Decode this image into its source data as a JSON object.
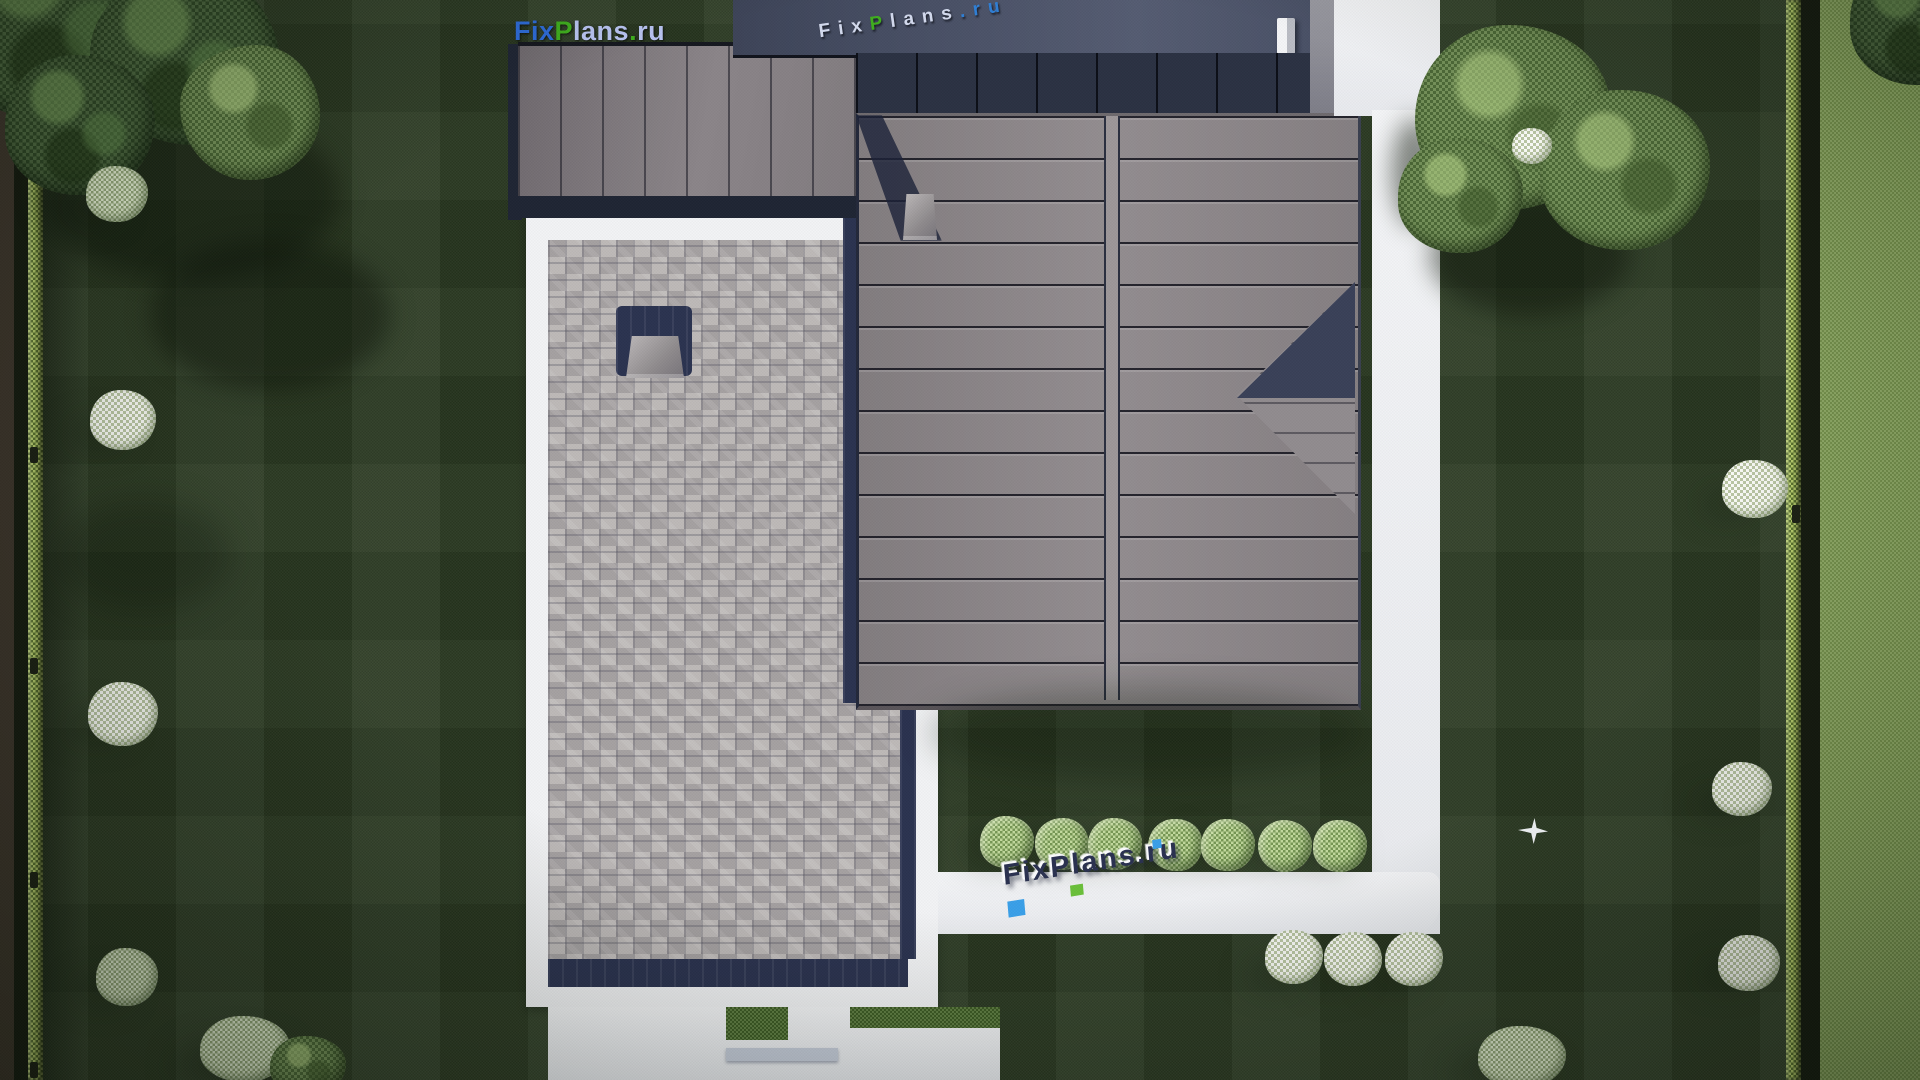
{
  "branding": {
    "logo": {
      "fix": "Fix",
      "p": "P",
      "lans": "lans",
      "dot": ".",
      "ru": "ru"
    },
    "roof_watermark": {
      "fix": "Fix",
      "p": "P",
      "lans": "lans",
      "dot": ".",
      "ru": "ru"
    },
    "path_watermark": {
      "text": "FixPlans.ru"
    }
  },
  "palette": {
    "lawn": "#2b3a22",
    "neighbor": "#87a45a",
    "hedgeGreen": "#9cb851",
    "pathWhite": "#f2f3f5",
    "paverGray": "#b2aeae",
    "navy": "#2b3350",
    "roofMain": "#8c8689",
    "roofNorth": "#434a5e",
    "logoBlue": "#2e6bd8",
    "logoGreen": "#3fae1e",
    "logoLight": "#b9c4f2",
    "wmDark": "#2a3150"
  },
  "scene": {
    "elements": [
      {
        "name": "dirt-strip-left",
        "cls": "strip-dirt",
        "x": 0,
        "y": 0,
        "w": 16,
        "h": 1080
      },
      {
        "name": "fence-strip-left",
        "cls": "strip-dark",
        "x": 14,
        "y": 0,
        "w": 16,
        "h": 1080
      },
      {
        "name": "hedge-left",
        "cls": "hedge",
        "x": 28,
        "y": 0,
        "w": 15,
        "h": 1080
      },
      {
        "name": "hedge-shadow-left",
        "cls": "shade-strip",
        "x": 43,
        "y": 0,
        "w": 46,
        "h": 1080
      },
      {
        "name": "hedge-right",
        "cls": "hedge",
        "x": 1786,
        "y": 0,
        "w": 15,
        "h": 1080
      },
      {
        "name": "fence-gap-right",
        "cls": "strip-dark",
        "x": 1801,
        "y": 0,
        "w": 21,
        "h": 1080
      },
      {
        "name": "neighbor-lawn",
        "cls": "neighbor",
        "x": 1820,
        "y": 0,
        "w": 100,
        "h": 1080
      },
      {
        "name": "fence-post-left-1",
        "cls": "post",
        "x": 30,
        "y": 447,
        "w": 8,
        "h": 16
      },
      {
        "name": "fence-post-left-2",
        "cls": "post",
        "x": 30,
        "y": 658,
        "w": 8,
        "h": 16
      },
      {
        "name": "fence-post-left-3",
        "cls": "post",
        "x": 30,
        "y": 872,
        "w": 8,
        "h": 16
      },
      {
        "name": "fence-post-left-4",
        "cls": "post",
        "x": 30,
        "y": 1062,
        "w": 8,
        "h": 16
      },
      {
        "name": "fence-post-right",
        "cls": "post",
        "x": 1792,
        "y": 505,
        "w": 8,
        "h": 18
      },
      {
        "name": "tree-shadow-topleft-1",
        "cls": "shadow",
        "x": 40,
        "y": 110,
        "w": 300,
        "h": 170
      },
      {
        "name": "tree-shadow-topleft-2",
        "cls": "shadow",
        "x": 150,
        "y": 240,
        "w": 240,
        "h": 150
      },
      {
        "name": "lawn-shadow-left",
        "cls": "shadow soft",
        "x": 60,
        "y": 500,
        "w": 170,
        "h": 110
      },
      {
        "name": "bush-shadow-l1",
        "cls": "shadow soft",
        "x": 62,
        "y": 196,
        "w": 58,
        "h": 26
      },
      {
        "name": "bush-shadow-l2",
        "cls": "shadow soft",
        "x": 68,
        "y": 420,
        "w": 58,
        "h": 26
      },
      {
        "name": "bush-shadow-l3",
        "cls": "shadow soft",
        "x": 66,
        "y": 712,
        "w": 62,
        "h": 28
      },
      {
        "name": "bush-shadow-l4",
        "cls": "shadow soft",
        "x": 72,
        "y": 978,
        "w": 58,
        "h": 26
      },
      {
        "name": "bush-shadow-r1",
        "cls": "shadow soft",
        "x": 1700,
        "y": 492,
        "w": 56,
        "h": 24
      },
      {
        "name": "bush-shadow-r2",
        "cls": "shadow soft",
        "x": 1692,
        "y": 792,
        "w": 54,
        "h": 22
      },
      {
        "name": "bush-shadow-r3",
        "cls": "shadow soft",
        "x": 1698,
        "y": 962,
        "w": 56,
        "h": 24
      },
      {
        "name": "cluster-shadow-bottomleft",
        "cls": "shadow soft",
        "x": 175,
        "y": 1040,
        "w": 120,
        "h": 50
      },
      {
        "name": "cluster-shadow-bottomright",
        "cls": "shadow soft",
        "x": 1452,
        "y": 1052,
        "w": 100,
        "h": 40
      },
      {
        "name": "terrace-frame",
        "cls": "white-frame",
        "x": 526,
        "y": 200,
        "w": 412,
        "h": 807
      },
      {
        "name": "patio-pavers",
        "cls": "pavers",
        "x": 548,
        "y": 240,
        "w": 360,
        "h": 721
      },
      {
        "name": "patio-navy-bottom",
        "cls": "navy-band",
        "x": 548,
        "y": 959,
        "w": 360,
        "h": 28
      },
      {
        "name": "patio-navy-right",
        "cls": "navy-band",
        "x": 900,
        "y": 700,
        "w": 16,
        "h": 259
      },
      {
        "name": "skylight-base",
        "cls": "navy-band",
        "x": 616,
        "y": 306,
        "w": 76,
        "h": 70,
        "r": "6px"
      },
      {
        "name": "skylight-cap",
        "cls": "chimney-cap",
        "x": 626,
        "y": 336,
        "w": 58,
        "h": 42
      },
      {
        "name": "roof-gutter-navy",
        "cls": "navy-band",
        "x": 843,
        "y": 113,
        "w": 17,
        "h": 590
      },
      {
        "name": "west-wing-edge",
        "cls": "dark-edge",
        "x": 508,
        "y": 44,
        "w": 14,
        "h": 176
      },
      {
        "name": "west-wing-roof",
        "cls": "wing",
        "x": 518,
        "y": 42,
        "w": 340,
        "h": 160
      },
      {
        "name": "west-wing-eave",
        "cls": "dark-edge",
        "x": 518,
        "y": 196,
        "w": 340,
        "h": 22
      },
      {
        "name": "garage-roof-north",
        "cls": "roof-north",
        "x": 733,
        "y": 0,
        "w": 577,
        "h": 55
      },
      {
        "name": "garage-chimney",
        "cls": "chimney-white",
        "x": 1277,
        "y": 18,
        "w": 18,
        "h": 36
      },
      {
        "name": "garage-roof-south",
        "cls": "roof-south",
        "x": 856,
        "y": 53,
        "w": 480,
        "h": 62
      },
      {
        "name": "garage-fascia",
        "cls": "fascia",
        "x": 1310,
        "y": 0,
        "w": 26,
        "h": 115
      },
      {
        "name": "main-roof",
        "cls": "roof-main",
        "x": 856,
        "y": 113,
        "w": 499,
        "h": 590
      },
      {
        "name": "main-roof-ridge",
        "cls": "roof-ridge",
        "x": 1106,
        "y": 116,
        "w": 12,
        "h": 584
      },
      {
        "name": "roof-notch-light",
        "cls": "notch-light",
        "x": 1237,
        "y": 282,
        "w": 118,
        "h": 232
      },
      {
        "name": "roof-notch-dark",
        "cls": "notch-dark",
        "x": 1237,
        "y": 282,
        "w": 118,
        "h": 116
      },
      {
        "name": "chimney-shadow",
        "cls": "chim-shadow",
        "x": 856,
        "y": 115,
        "w": 86,
        "h": 126
      },
      {
        "name": "main-roof-chimney",
        "cls": "chimney-cap",
        "x": 903,
        "y": 194,
        "w": 34,
        "h": 46
      },
      {
        "name": "roof-south-shadow",
        "cls": "shadow soft",
        "x": 930,
        "y": 688,
        "w": 440,
        "h": 90
      },
      {
        "name": "driveway",
        "cls": "path-white",
        "x": 1334,
        "y": 0,
        "w": 106,
        "h": 116
      },
      {
        "name": "east-path",
        "cls": "path-white",
        "x": 1372,
        "y": 110,
        "w": 68,
        "h": 824
      },
      {
        "name": "south-walkway",
        "cls": "path-white",
        "x": 938,
        "y": 872,
        "w": 502,
        "h": 62,
        "r": "0 12px 30px 0"
      },
      {
        "name": "entry-slab",
        "cls": "path-white",
        "x": 548,
        "y": 1007,
        "w": 452,
        "h": 73
      },
      {
        "name": "entry-grass-gap-1",
        "cls": "grass-patch",
        "x": 726,
        "y": 1007,
        "w": 62,
        "h": 33
      },
      {
        "name": "entry-grass-gap-2",
        "cls": "grass-patch",
        "x": 850,
        "y": 1007,
        "w": 150,
        "h": 21
      },
      {
        "name": "entry-step",
        "cls": "step-strip",
        "x": 726,
        "y": 1048,
        "w": 112,
        "h": 13
      },
      {
        "name": "path-tree-shadow",
        "cls": "shadow",
        "x": 1392,
        "y": 118,
        "w": 46,
        "h": 110
      },
      {
        "name": "tree-shadow-topright",
        "cls": "shadow",
        "x": 1430,
        "y": 195,
        "w": 200,
        "h": 120
      },
      {
        "name": "smalltree-shadow-1",
        "cls": "shadow soft",
        "x": 962,
        "y": 830,
        "w": 60,
        "h": 34
      },
      {
        "name": "smalltree-shadow-2",
        "cls": "shadow soft",
        "x": 1017,
        "y": 832,
        "w": 60,
        "h": 34
      },
      {
        "name": "smalltree-shadow-3",
        "cls": "shadow soft",
        "x": 1070,
        "y": 832,
        "w": 60,
        "h": 34
      },
      {
        "name": "smalltree-shadow-4",
        "cls": "shadow soft",
        "x": 1130,
        "y": 833,
        "w": 60,
        "h": 34
      },
      {
        "name": "smalltree-shadow-5",
        "cls": "shadow soft",
        "x": 1183,
        "y": 833,
        "w": 60,
        "h": 34
      },
      {
        "name": "smalltree-shadow-6",
        "cls": "shadow soft",
        "x": 1240,
        "y": 834,
        "w": 60,
        "h": 34
      },
      {
        "name": "smalltree-shadow-7",
        "cls": "shadow soft",
        "x": 1295,
        "y": 834,
        "w": 60,
        "h": 34
      },
      {
        "name": "whitebush-shadow-1",
        "cls": "shadow soft",
        "x": 1248,
        "y": 962,
        "w": 52,
        "h": 26
      },
      {
        "name": "whitebush-shadow-2",
        "cls": "shadow soft",
        "x": 1307,
        "y": 964,
        "w": 52,
        "h": 26
      },
      {
        "name": "whitebush-shadow-3",
        "cls": "shadow soft",
        "x": 1368,
        "y": 964,
        "w": 52,
        "h": 26
      },
      {
        "name": "tree-topleft-a",
        "cls": "tree-dark",
        "x": -50,
        "y": -80,
        "w": 220,
        "h": 200,
        "r": "45% 55% 52% 48%/50% 50% 58% 42%"
      },
      {
        "name": "tree-topleft-b",
        "cls": "tree-dark",
        "x": 90,
        "y": -30,
        "w": 190,
        "h": 175,
        "r": "52% 48% 45% 55%/48% 55% 45% 52%"
      },
      {
        "name": "tree-topleft-c",
        "cls": "tree-dark",
        "x": 5,
        "y": 55,
        "w": 150,
        "h": 140
      },
      {
        "name": "tree-topleft-d",
        "cls": "tree-med",
        "x": 180,
        "y": 45,
        "w": 140,
        "h": 135,
        "r": "55% 45% 50% 50%/45% 52% 48% 55%"
      },
      {
        "name": "bush-left-1",
        "cls": "bush-sage",
        "x": 86,
        "y": 166,
        "w": 62,
        "h": 56
      },
      {
        "name": "bush-left-2",
        "cls": "bush-white",
        "x": 90,
        "y": 390,
        "w": 66,
        "h": 60
      },
      {
        "name": "bush-left-3",
        "cls": "bush-white",
        "x": 88,
        "y": 682,
        "w": 70,
        "h": 64
      },
      {
        "name": "bush-left-4",
        "cls": "bush-sage",
        "x": 96,
        "y": 948,
        "w": 62,
        "h": 58
      },
      {
        "name": "bush-cluster-bottomleft-1",
        "cls": "bush-sage",
        "x": 200,
        "y": 1016,
        "w": 90,
        "h": 66
      },
      {
        "name": "bush-cluster-bottomleft-2",
        "cls": "tree-med",
        "x": 270,
        "y": 1036,
        "w": 76,
        "h": 60
      },
      {
        "name": "tree-topright-a",
        "cls": "tree-med",
        "x": 1415,
        "y": 25,
        "w": 195,
        "h": 185,
        "r": "48% 52% 55% 45%/52% 45% 50% 50%"
      },
      {
        "name": "tree-topright-b",
        "cls": "tree-med",
        "x": 1540,
        "y": 90,
        "w": 170,
        "h": 160
      },
      {
        "name": "tree-topright-c",
        "cls": "tree-med",
        "x": 1398,
        "y": 138,
        "w": 125,
        "h": 115
      },
      {
        "name": "bush-topright-white",
        "cls": "bush-white",
        "x": 1512,
        "y": 128,
        "w": 40,
        "h": 36
      },
      {
        "name": "tree-corner-topright",
        "cls": "tree-dark",
        "x": 1850,
        "y": -45,
        "w": 135,
        "h": 130
      },
      {
        "name": "bush-right-1",
        "cls": "bush-white",
        "x": 1722,
        "y": 460,
        "w": 66,
        "h": 58
      },
      {
        "name": "bush-right-2",
        "cls": "bush-white",
        "x": 1712,
        "y": 762,
        "w": 60,
        "h": 54
      },
      {
        "name": "bush-right-3",
        "cls": "bush-white",
        "x": 1718,
        "y": 935,
        "w": 62,
        "h": 56
      },
      {
        "name": "bush-cluster-bottomright",
        "cls": "bush-sage",
        "x": 1478,
        "y": 1026,
        "w": 88,
        "h": 62
      },
      {
        "name": "small-tree-1",
        "cls": "tree-small",
        "x": 980,
        "y": 816,
        "w": 54,
        "h": 52
      },
      {
        "name": "small-tree-2",
        "cls": "tree-small",
        "x": 1035,
        "y": 818,
        "w": 54,
        "h": 52,
        "r": "52% 48% 50% 50%/48% 52% 50% 50%"
      },
      {
        "name": "small-tree-3",
        "cls": "tree-small",
        "x": 1088,
        "y": 818,
        "w": 54,
        "h": 52
      },
      {
        "name": "small-tree-4",
        "cls": "tree-small",
        "x": 1148,
        "y": 819,
        "w": 54,
        "h": 52,
        "r": "50% 50% 45% 55%/55% 45% 50% 50%"
      },
      {
        "name": "small-tree-5",
        "cls": "tree-small",
        "x": 1201,
        "y": 819,
        "w": 54,
        "h": 52
      },
      {
        "name": "small-tree-6",
        "cls": "tree-small",
        "x": 1258,
        "y": 820,
        "w": 54,
        "h": 52,
        "r": "48% 52% 52% 48%/50% 48% 52% 50%"
      },
      {
        "name": "small-tree-7",
        "cls": "tree-small",
        "x": 1313,
        "y": 820,
        "w": 54,
        "h": 52
      },
      {
        "name": "flower-bush-1",
        "cls": "bush-white",
        "x": 1265,
        "y": 930,
        "w": 58,
        "h": 54
      },
      {
        "name": "flower-bush-2",
        "cls": "bush-white",
        "x": 1324,
        "y": 932,
        "w": 58,
        "h": 54,
        "r": "52% 48% 50% 50%/48% 52% 50% 50%"
      },
      {
        "name": "flower-bush-3",
        "cls": "bush-white",
        "x": 1385,
        "y": 932,
        "w": 58,
        "h": 54
      },
      {
        "name": "flying-bird",
        "cls": "bird",
        "x": 1518,
        "y": 818,
        "w": 30,
        "h": 26
      }
    ]
  }
}
